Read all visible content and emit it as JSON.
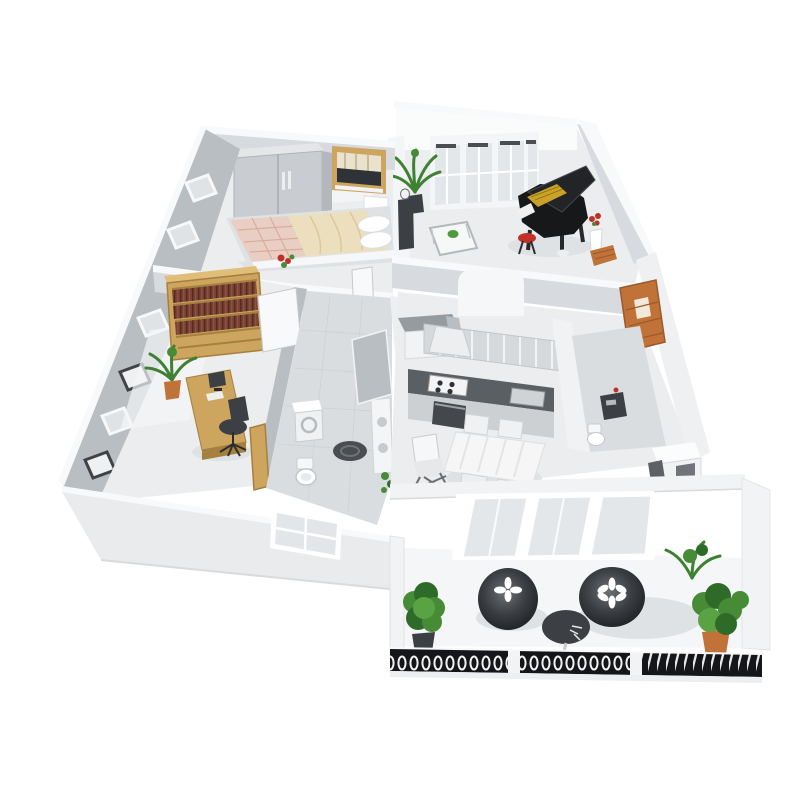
{
  "meta": {
    "title": "3D isometric cutaway floor plan render of a one-bedroom apartment with balcony",
    "view": "aerial three-quarter cutaway, white background, no text or UI labels"
  },
  "colors": {
    "bg": "#ffffff",
    "wall_top": "#f8f9fa",
    "wall_white": "#fafbfb",
    "wall_light": "#d7dade",
    "wall_mid": "#b9bec3",
    "wall_dark": "#a3a9ae",
    "floor_light": "#ebedee",
    "floor_tile": "#dadde0",
    "slab": "#f1f3f4",
    "wood": "#cda55e",
    "wood_dark": "#a5803e",
    "book": "#6f3a30",
    "piano": "#17181a",
    "gold": "#c9a227",
    "bed_cream": "#ecdfbe",
    "bed_pink": "#e9cfc3",
    "green": "#478b37",
    "green_dark": "#2f6b28",
    "terracotta": "#c07238",
    "dark_furn": "#3c4044",
    "counter": "#5a5f64",
    "glass": "#e3e7ea",
    "railing": "#151619",
    "red": "#c23128",
    "white": "#ffffff",
    "shadow": "#dfe2e4"
  },
  "scene": {
    "rooms": [
      {
        "name": "bedroom",
        "position": "top-left",
        "furniture": [
          "double-door wardrobe",
          "double bed with cream and plaid bedding",
          "two white pillows",
          "wood-framed window",
          "nightstand",
          "red flower bouquet"
        ]
      },
      {
        "name": "living-room",
        "position": "top-right",
        "furniture": [
          "french windows",
          "black grand piano with open lid",
          "red piano stool",
          "glass coffee table",
          "potted palm",
          "dark media cabinet",
          "red flowers in white vase",
          "wicker basket"
        ]
      },
      {
        "name": "study",
        "position": "middle-left",
        "furniture": [
          "full-height wooden bookshelf with books",
          "wooden desk with computer",
          "black office chair",
          "potted plant",
          "open white door",
          "open wooden door"
        ]
      },
      {
        "name": "bathroom-laundry",
        "position": "center",
        "furniture": [
          "washing machine",
          "toilet",
          "dark round bath mat",
          "tall white cabinet",
          "green plants",
          "open gray door"
        ]
      },
      {
        "name": "kitchen-dining",
        "position": "middle-right",
        "furniture": [
          "upper cabinets",
          "range hood",
          "dark countertop with cooktop and sink",
          "oven",
          "refrigerator niche",
          "gray-top hall cabinet",
          "dining table with white cloth",
          "four chairs",
          "high chair",
          "carved wooden entry panel"
        ]
      },
      {
        "name": "wc",
        "position": "right",
        "furniture": [
          "dark vanity",
          "toilet",
          "white desk with drawers",
          "stool"
        ]
      },
      {
        "name": "balcony",
        "position": "bottom-right",
        "furniture": [
          "sliding glass doors",
          "two round dark lounge poufs with white flower motifs",
          "round dark side table",
          "three potted green plants",
          "terracotta pot",
          "ornamental black railing with three segments"
        ]
      }
    ]
  }
}
